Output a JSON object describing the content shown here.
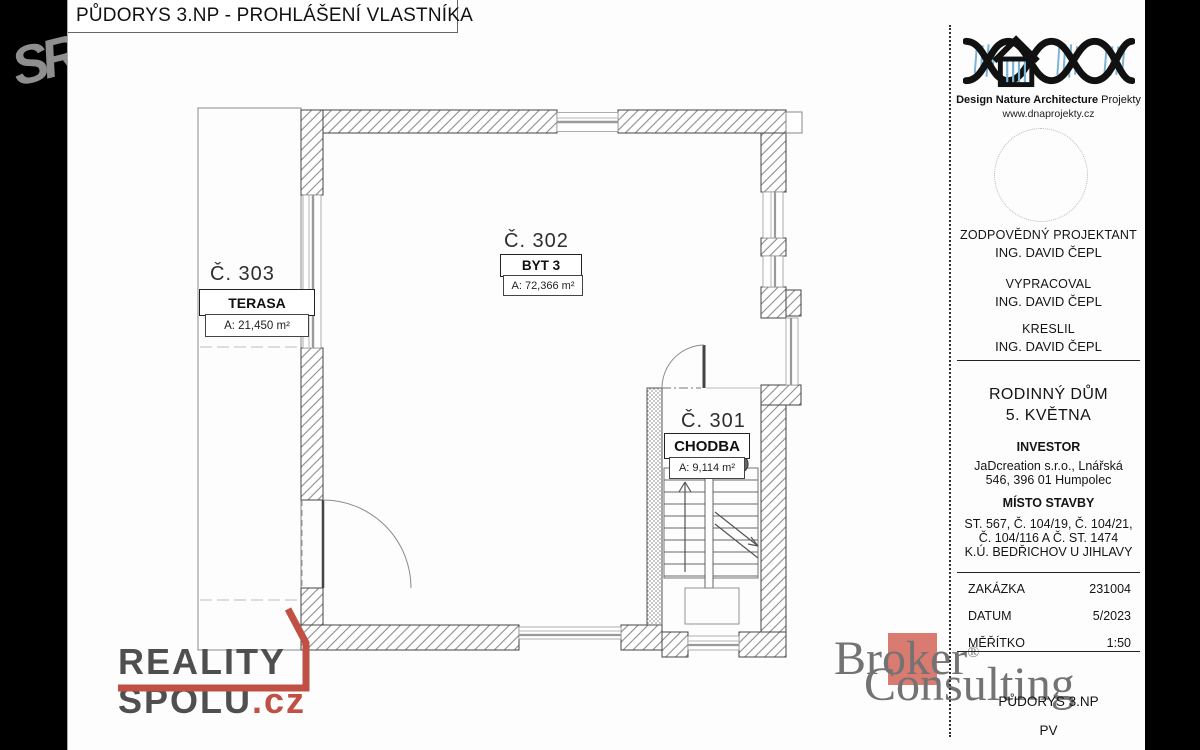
{
  "page": {
    "title": "PŮDORYS 3.NP - PROHLÁŠENÍ VLASTNÍKA"
  },
  "watermarks": {
    "sr": "SR",
    "reality_word": "REALITY",
    "spolu_word": "SPOLU",
    "spolu_tld": ".cz",
    "broker_word": "Broker",
    "broker_reg": "®",
    "consulting_word": "Consulting"
  },
  "rooms": [
    {
      "number": "Č. 303",
      "name": "TERASA",
      "area": "A: 21,450 m²"
    },
    {
      "number": "Č. 302",
      "name": "BYT 3",
      "area": "A: 72,366 m²"
    },
    {
      "number": "Č. 301",
      "name": "CHODBA",
      "area": "A: 9,114 m²"
    }
  ],
  "title_block": {
    "logo": {
      "brand_bold": "Design Nature Architecture",
      "brand_regular": " Projekty",
      "website": "www.dnaprojekty.cz"
    },
    "roles": [
      {
        "label": "ZODPOVĚDNÝ PROJEKTANT",
        "value": "ING. DAVID ČEPL"
      },
      {
        "label": "VYPRACOVAL",
        "value": "ING. DAVID ČEPL"
      },
      {
        "label": "KRESLIL",
        "value": "ING. DAVID ČEPL"
      }
    ],
    "project": {
      "line1": "RODINNÝ DŮM",
      "line2": "5. KVĚTNA"
    },
    "investor": {
      "label": "INVESTOR",
      "line1": "JaDcreation s.r.o., Lnářská",
      "line2": "546, 396 01 Humpolec"
    },
    "site": {
      "label": "MÍSTO STAVBY",
      "line1": "ST. 567, Č. 104/19, Č. 104/21,",
      "line2": "Č. 104/116 A Č. ST. 1474",
      "line3": "K.Ú. BEDŘICHOV U JIHLAVY"
    },
    "meta": [
      {
        "label": "ZAKÁZKA",
        "value": "231004"
      },
      {
        "label": "DATUM",
        "value": "5/2023"
      },
      {
        "label": "MĚŘÍTKO",
        "value": "1:50"
      }
    ],
    "drawing_name": "PŮDORYS 3.NP",
    "drawing_code": "PV"
  }
}
